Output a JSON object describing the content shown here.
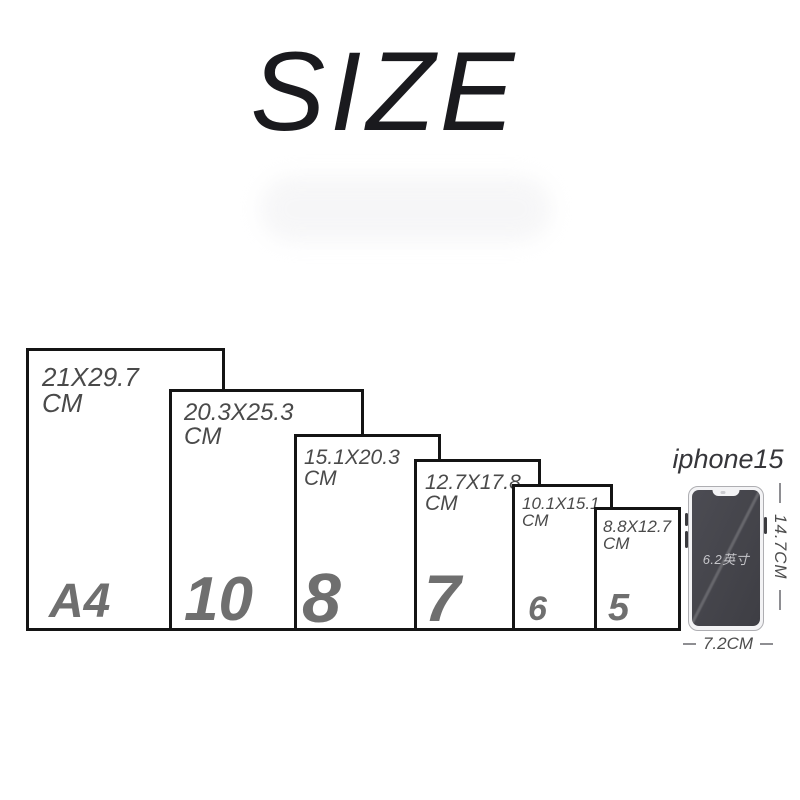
{
  "title": "SIZE",
  "papers": [
    {
      "name": "A4",
      "dimensions": "21X29.7",
      "unit": "CM"
    },
    {
      "name": "10",
      "dimensions": "20.3X25.3",
      "unit": "CM"
    },
    {
      "name": "8",
      "dimensions": "15.1X20.3",
      "unit": "CM"
    },
    {
      "name": "7",
      "dimensions": "12.7X17.8",
      "unit": "CM"
    },
    {
      "name": "6",
      "dimensions": "10.1X15.1",
      "unit": "CM"
    },
    {
      "name": "5",
      "dimensions": "8.8X12.7",
      "unit": "CM"
    }
  ],
  "phone": {
    "label": "iphone15",
    "screen_size": "6.2英寸",
    "height_label": "14.7CM",
    "width_label": "7.2CM"
  },
  "colors": {
    "paper_border": "#141414",
    "number_gray": "#6f6f6f",
    "dimension_text_gray": "#4a4a4a",
    "title_black": "#1a1a1e",
    "phone_screen_dark": "#46464c",
    "phone_frame_light": "#f3f3f5"
  }
}
